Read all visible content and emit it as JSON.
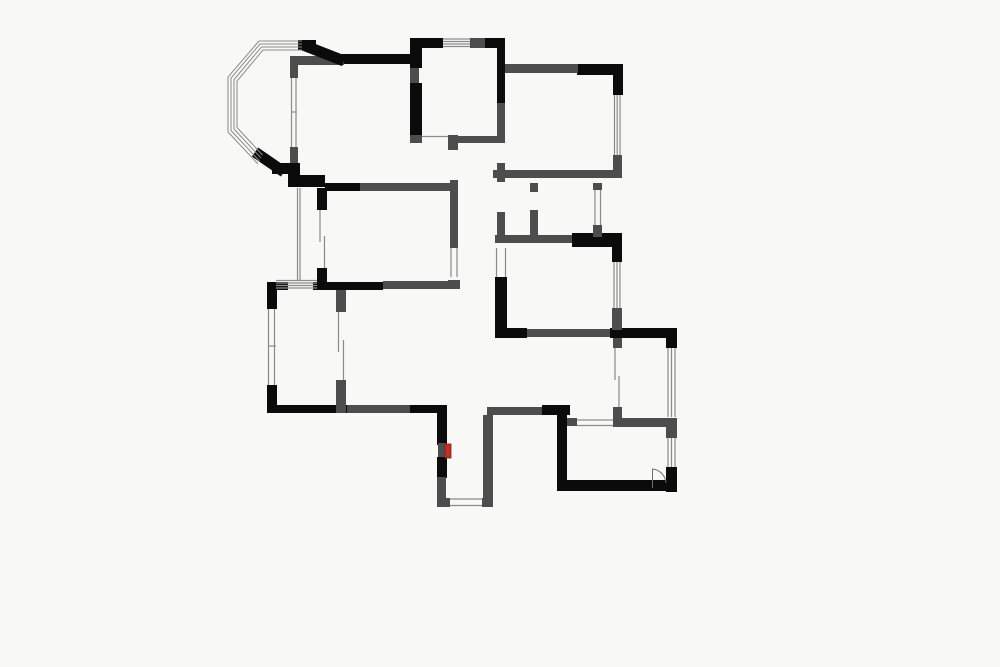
{
  "canvas": {
    "width": 1000,
    "height": 667,
    "background": "#f8f8f7"
  },
  "colors": {
    "structural": "#0b0b0b",
    "partition": "#4d4d4d",
    "window_line": "#8a8a8a",
    "thin_dark": "#6f6f6f",
    "accent_red": "#c03028"
  },
  "plan": {
    "rects": [
      [
        342,
        54,
        71,
        10,
        "k"
      ],
      [
        298,
        40,
        18,
        10,
        "k"
      ],
      [
        410,
        38,
        33,
        10,
        "k"
      ],
      [
        485,
        38,
        20,
        10,
        "k"
      ],
      [
        410,
        38,
        12,
        30,
        "k"
      ],
      [
        410,
        83,
        12,
        52,
        "k"
      ],
      [
        497,
        41,
        8,
        62,
        "k"
      ],
      [
        577,
        64,
        46,
        11,
        "k"
      ],
      [
        613,
        67,
        10,
        28,
        "k"
      ],
      [
        572,
        233,
        50,
        14,
        "k"
      ],
      [
        612,
        235,
        10,
        27,
        "k"
      ],
      [
        495,
        277,
        12,
        58,
        "k"
      ],
      [
        495,
        328,
        32,
        10,
        "k"
      ],
      [
        610,
        328,
        67,
        10,
        "k"
      ],
      [
        666,
        330,
        11,
        18,
        "k"
      ],
      [
        666,
        467,
        11,
        25,
        "k"
      ],
      [
        557,
        480,
        120,
        11,
        "k"
      ],
      [
        557,
        407,
        10,
        83,
        "k"
      ],
      [
        542,
        405,
        28,
        10,
        "k"
      ],
      [
        437,
        405,
        10,
        40,
        "k"
      ],
      [
        437,
        457,
        10,
        21,
        "k"
      ],
      [
        267,
        282,
        21,
        8,
        "k"
      ],
      [
        313,
        282,
        70,
        8,
        "k"
      ],
      [
        453,
        280,
        7,
        9,
        "k"
      ],
      [
        267,
        282,
        10,
        27,
        "k"
      ],
      [
        267,
        385,
        10,
        28,
        "k"
      ],
      [
        267,
        405,
        80,
        8,
        "k"
      ],
      [
        410,
        405,
        28,
        8,
        "k"
      ],
      [
        288,
        163,
        12,
        24,
        "k"
      ],
      [
        272,
        163,
        27,
        11,
        "k"
      ],
      [
        288,
        175,
        37,
        12,
        "k"
      ],
      [
        325,
        183,
        35,
        8,
        "k"
      ],
      [
        317,
        188,
        10,
        22,
        "k"
      ],
      [
        317,
        268,
        10,
        20,
        "k"
      ],
      [
        470,
        38,
        15,
        10,
        "g"
      ],
      [
        410,
        68,
        9,
        15,
        "g"
      ],
      [
        497,
        103,
        8,
        40,
        "g"
      ],
      [
        410,
        135,
        12,
        8,
        "g"
      ],
      [
        448,
        135,
        10,
        15,
        "g"
      ],
      [
        458,
        136,
        39,
        7,
        "g"
      ],
      [
        450,
        180,
        8,
        68,
        "g"
      ],
      [
        448,
        280,
        12,
        9,
        "g"
      ],
      [
        505,
        64,
        73,
        9,
        "g"
      ],
      [
        613,
        155,
        9,
        23,
        "g"
      ],
      [
        493,
        170,
        127,
        8,
        "g"
      ],
      [
        497,
        163,
        8,
        19,
        "g"
      ],
      [
        497,
        212,
        8,
        31,
        "g"
      ],
      [
        530,
        183,
        8,
        9,
        "g"
      ],
      [
        530,
        210,
        8,
        27,
        "g"
      ],
      [
        593,
        183,
        9,
        7,
        "g"
      ],
      [
        593,
        225,
        9,
        12,
        "g"
      ],
      [
        495,
        235,
        77,
        8,
        "g"
      ],
      [
        612,
        308,
        10,
        22,
        "g"
      ],
      [
        527,
        329,
        83,
        8,
        "g"
      ],
      [
        613,
        338,
        9,
        10,
        "g"
      ],
      [
        613,
        407,
        9,
        11,
        "g"
      ],
      [
        613,
        418,
        55,
        9,
        "g"
      ],
      [
        666,
        418,
        11,
        20,
        "g"
      ],
      [
        567,
        418,
        10,
        8,
        "g"
      ],
      [
        487,
        407,
        55,
        8,
        "g"
      ],
      [
        483,
        415,
        10,
        92,
        "g"
      ],
      [
        437,
        477,
        9,
        21,
        "g"
      ],
      [
        437,
        498,
        13,
        9,
        "g"
      ],
      [
        482,
        498,
        11,
        9,
        "g"
      ],
      [
        347,
        405,
        63,
        8,
        "g"
      ],
      [
        336,
        290,
        10,
        22,
        "g"
      ],
      [
        336,
        380,
        10,
        33,
        "g"
      ],
      [
        360,
        183,
        98,
        8,
        "g"
      ],
      [
        383,
        281,
        70,
        8,
        "g"
      ],
      [
        290,
        65,
        8,
        13,
        "g"
      ],
      [
        290,
        147,
        8,
        16,
        "g"
      ],
      [
        290,
        56,
        54,
        9,
        "g"
      ],
      [
        438,
        443,
        8,
        14,
        "g"
      ]
    ],
    "diagonals": [
      [
        303,
        45,
        344,
        61,
        "k",
        11
      ],
      [
        255,
        152,
        284,
        172,
        "k",
        11
      ]
    ],
    "window_hlines": [
      [
        443,
        39,
        470,
        39
      ],
      [
        443,
        41.5,
        470,
        41.5
      ],
      [
        443,
        44,
        470,
        44
      ],
      [
        443,
        46.5,
        470,
        46.5
      ],
      [
        577,
        420,
        613,
        420
      ],
      [
        577,
        425.5,
        613,
        425.5
      ],
      [
        450,
        499,
        482,
        499
      ],
      [
        450,
        505.5,
        482,
        505.5
      ],
      [
        422,
        136.5,
        448,
        136.5
      ],
      [
        291,
        112,
        297,
        112
      ],
      [
        268,
        346,
        276,
        346
      ],
      [
        276,
        280.5,
        317,
        280.5
      ],
      [
        276,
        283,
        317,
        283
      ],
      [
        276,
        285.5,
        317,
        285.5
      ],
      [
        276,
        288,
        317,
        288
      ]
    ],
    "window_vlines": [
      [
        291.5,
        78,
        291.5,
        147
      ],
      [
        296,
        78,
        296,
        147
      ],
      [
        614.5,
        95,
        614.5,
        155
      ],
      [
        617.2,
        95,
        617.2,
        155
      ],
      [
        620,
        95,
        620,
        155
      ],
      [
        595,
        190,
        595,
        225
      ],
      [
        600.5,
        190,
        600.5,
        225
      ],
      [
        614,
        262,
        614,
        308
      ],
      [
        617,
        262,
        617,
        308
      ],
      [
        620,
        262,
        620,
        308
      ],
      [
        668,
        348,
        668,
        417
      ],
      [
        671.5,
        348,
        671.5,
        417
      ],
      [
        675,
        348,
        675,
        417
      ],
      [
        668,
        438,
        668,
        467
      ],
      [
        671.5,
        438,
        671.5,
        467
      ],
      [
        675,
        438,
        675,
        467
      ],
      [
        268.5,
        309,
        268.5,
        385
      ],
      [
        274.5,
        309,
        274.5,
        385
      ],
      [
        297.5,
        188,
        297.5,
        280
      ],
      [
        300,
        188,
        300,
        280
      ],
      [
        451,
        248,
        451,
        277
      ],
      [
        457,
        248,
        457,
        277
      ],
      [
        496.5,
        248,
        496.5,
        277
      ],
      [
        505.5,
        248,
        505.5,
        277
      ],
      [
        338.5,
        312,
        338.5,
        352
      ],
      [
        343.5,
        340,
        343.5,
        380
      ],
      [
        320,
        210,
        320,
        242
      ],
      [
        324.5,
        236,
        324.5,
        268
      ],
      [
        615,
        348,
        615,
        380
      ],
      [
        619,
        376,
        619,
        407
      ]
    ],
    "bay_polylines": [
      "302,41 259,41 228,77 228,132 258,164",
      "302,44 260,44 231,78 231,130.5 259.5,161",
      "302,47 261.5,47 234,79.5 234,129 261,158",
      "302,50 263,50 237,81 237,127.5 262.5,155"
    ],
    "door_swings": [
      "M652.5,488 V469 A15,15 0 0 1 666,483"
    ],
    "red_markers": [
      [
        445,
        444,
        6,
        14
      ]
    ]
  }
}
